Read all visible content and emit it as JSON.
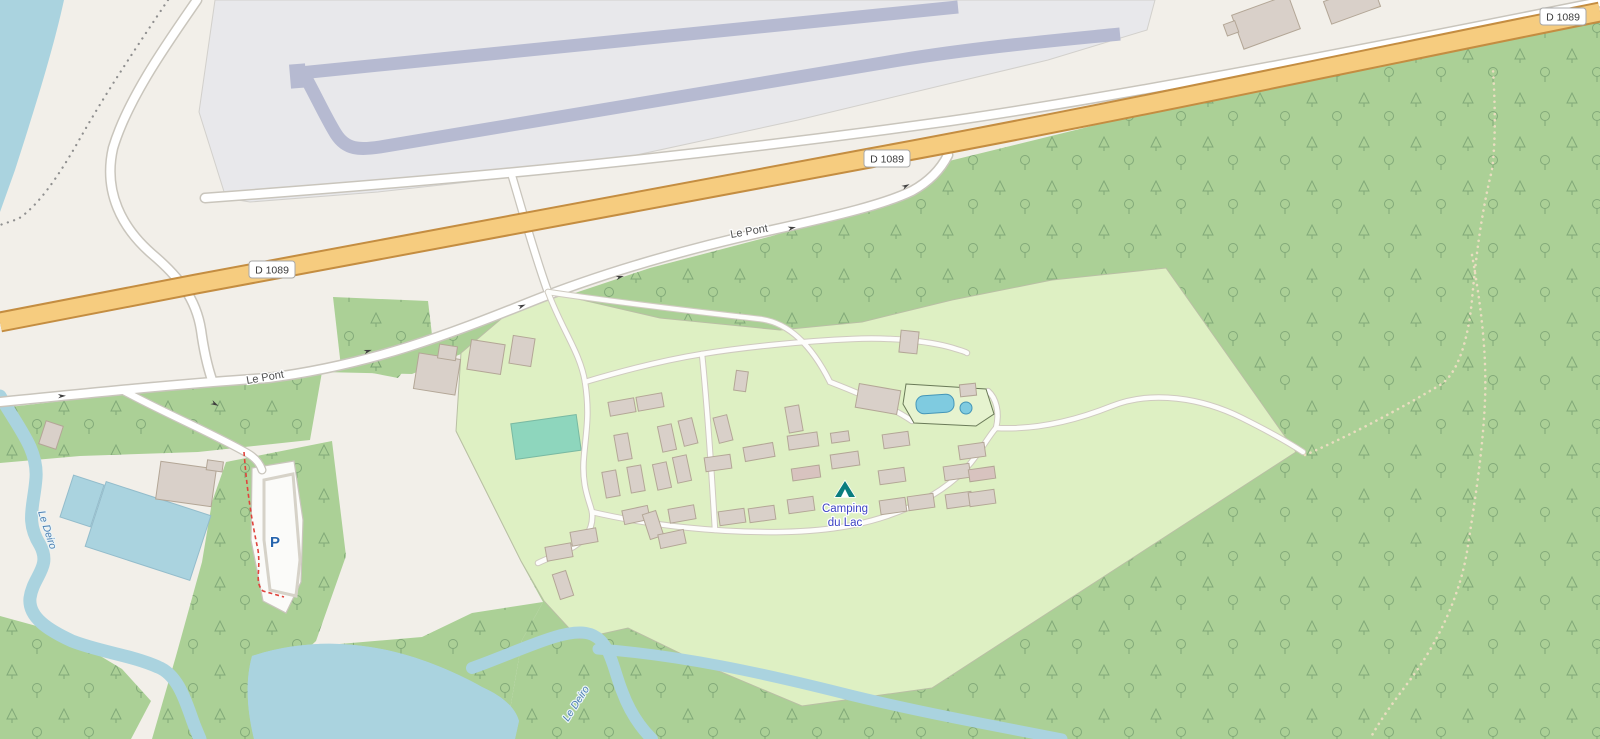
{
  "map": {
    "road_refs": {
      "d1089": "D 1089"
    },
    "streets": {
      "le_pont": "Le Pont"
    },
    "waterways": {
      "le_deiro": "Le Deiro"
    },
    "pois": {
      "campsite": {
        "line1": "Camping",
        "line2": "du Lac",
        "icon": "tent-icon"
      },
      "parking": {
        "label": "P",
        "icon": "parking-icon"
      }
    },
    "colors": {
      "land": "#f2efe9",
      "water": "#aad3df",
      "forest": "#abd096",
      "campsite": "#def0c3",
      "road_primary_fill": "#f6cc7f",
      "road_primary_casing": "#c48d41",
      "road_white": "#ffffff",
      "platform": "#e8e8eb",
      "platform_band": "#b6bad1",
      "building": "#d9d0c9",
      "pool": "#7fcbe0",
      "pitch": "#8ed6bd",
      "label_street": "#4e4e4e",
      "label_water": "#4d80b3",
      "label_accommodation": "#3d43c4",
      "parking_blue": "#2765ad",
      "trail_red": "#e0433c"
    }
  }
}
